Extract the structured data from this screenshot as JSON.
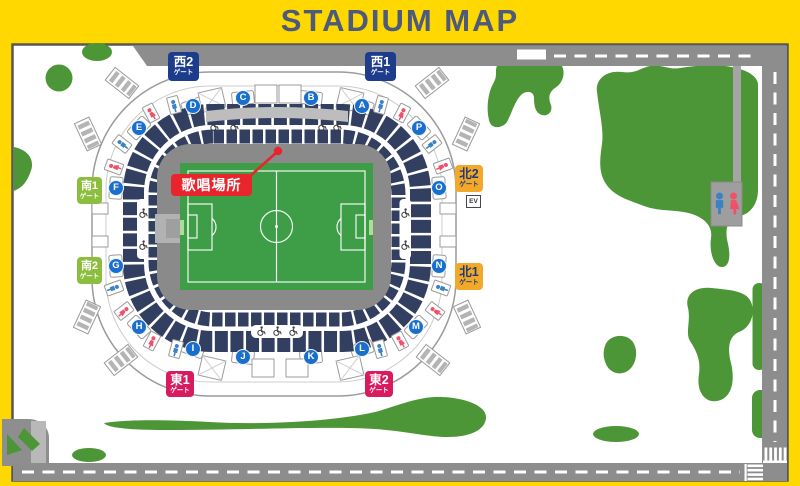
{
  "title": "STADIUM MAP",
  "stadium": {
    "sections": [
      "A",
      "B",
      "C",
      "D",
      "E",
      "F",
      "G",
      "H",
      "I",
      "J",
      "K",
      "L",
      "M",
      "N",
      "O",
      "P"
    ],
    "gates": [
      {
        "name": "西2",
        "suffix": "ゲート",
        "side": "west"
      },
      {
        "name": "西1",
        "suffix": "ゲート",
        "side": "west"
      },
      {
        "name": "北2",
        "suffix": "ゲート",
        "side": "north"
      },
      {
        "name": "北1",
        "suffix": "ゲート",
        "side": "north"
      },
      {
        "name": "南1",
        "suffix": "ゲート",
        "side": "south"
      },
      {
        "name": "南2",
        "suffix": "ゲート",
        "side": "south"
      },
      {
        "name": "東1",
        "suffix": "ゲート",
        "side": "east"
      },
      {
        "name": "東2",
        "suffix": "ゲート",
        "side": "east"
      }
    ],
    "singing_spot_label": "歌唱場所",
    "elevator_label": "EV"
  },
  "icons": {
    "mens_restroom": "man-figure-icon",
    "womens_restroom": "woman-figure-icon",
    "wheelchair": "wheelchair-icon",
    "restroom_sign": "restroom-sign"
  },
  "colors": {
    "frame_yellow": "#FFD800",
    "title_text": "#4D5A7B",
    "road_gray": "#8D8D8D",
    "grass_green": "#4D9637",
    "pitch_green": "#3E9E47",
    "seating_navy": "#323F60",
    "field_surround_gray": "#8A8A8A",
    "west_gate_blue": "#1D3C8C",
    "north_gate_yellow": "#F2A929",
    "south_gate_green": "#8CBE3E",
    "east_gate_red": "#D91A5E",
    "section_badge_blue": "#1A6FCC",
    "highlight_red": "#E8252D",
    "men_icon_blue": "#3B82C4",
    "women_icon_red": "#F0506A"
  }
}
